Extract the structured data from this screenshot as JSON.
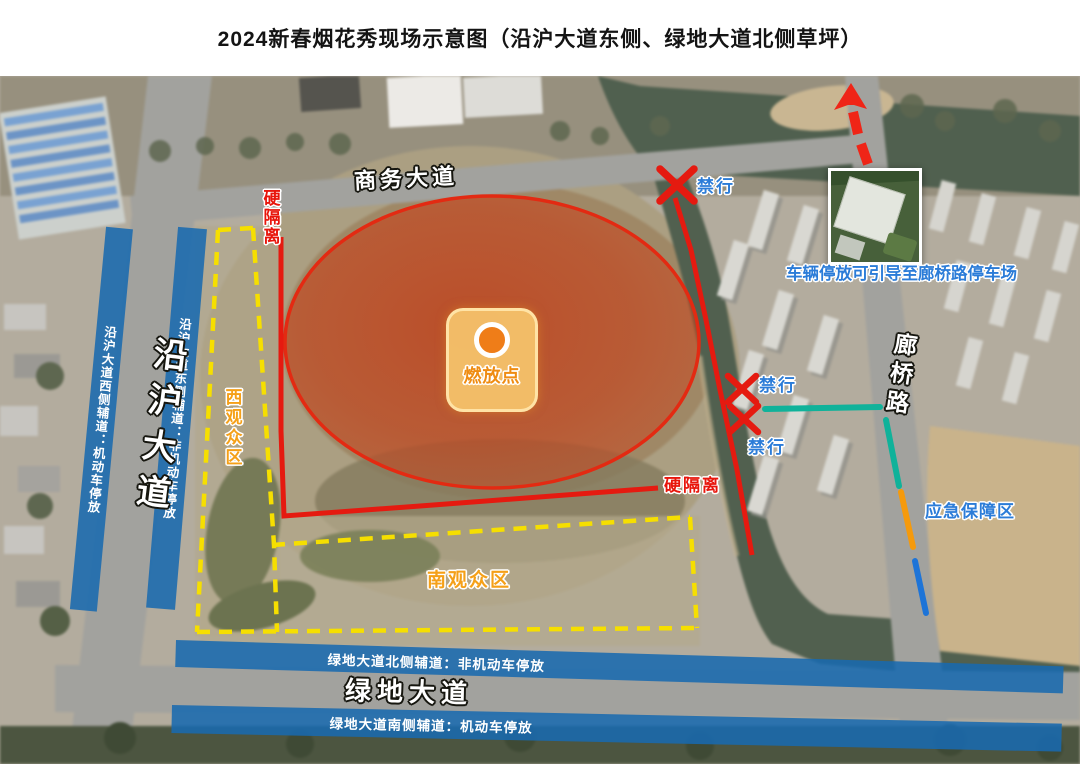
{
  "title": "2024新春烟花秀现场示意图（沿沪大道东侧、绿地大道北侧草坪）",
  "roads": {
    "shangwu": "商务大道",
    "yanhu": "沿沪大道",
    "langqiao": "廊桥路",
    "lvdi": "绿地大道"
  },
  "parking_strips": {
    "yanhu_west": "沿沪大道西侧辅道：机动车停放",
    "yanhu_east": "沿沪大道东侧辅道：非机动车停放",
    "lvdi_north": "绿地大道北侧辅道：非机动车停放",
    "lvdi_south": "绿地大道南侧辅道：机动车停放"
  },
  "zones": {
    "west_audience": "西观众区",
    "south_audience": "南观众区",
    "emergency_support": "应急保障区"
  },
  "ignition": {
    "label": "燃放点"
  },
  "barriers": {
    "hard_isolation_left": "硬隔离",
    "hard_isolation_south": "硬隔离"
  },
  "no_entry": {
    "top": "禁行",
    "middle": "禁行",
    "bottom": "禁行"
  },
  "notes": {
    "parking_guidance": "车辆停放可引导至廊桥路停车场"
  },
  "colors": {
    "barrier_red": "#e51a10",
    "zone_dash_yellow": "#f6df00",
    "strip_blue": "#186ab0",
    "label_blue": "#2b7cd8",
    "zone_label_orange": "#f5a018",
    "emergency_teal": "#10b29a",
    "emergency_orange": "#f59a0c",
    "emergency_blue": "#1d74d8",
    "danger_fill": "#cd3a12"
  }
}
